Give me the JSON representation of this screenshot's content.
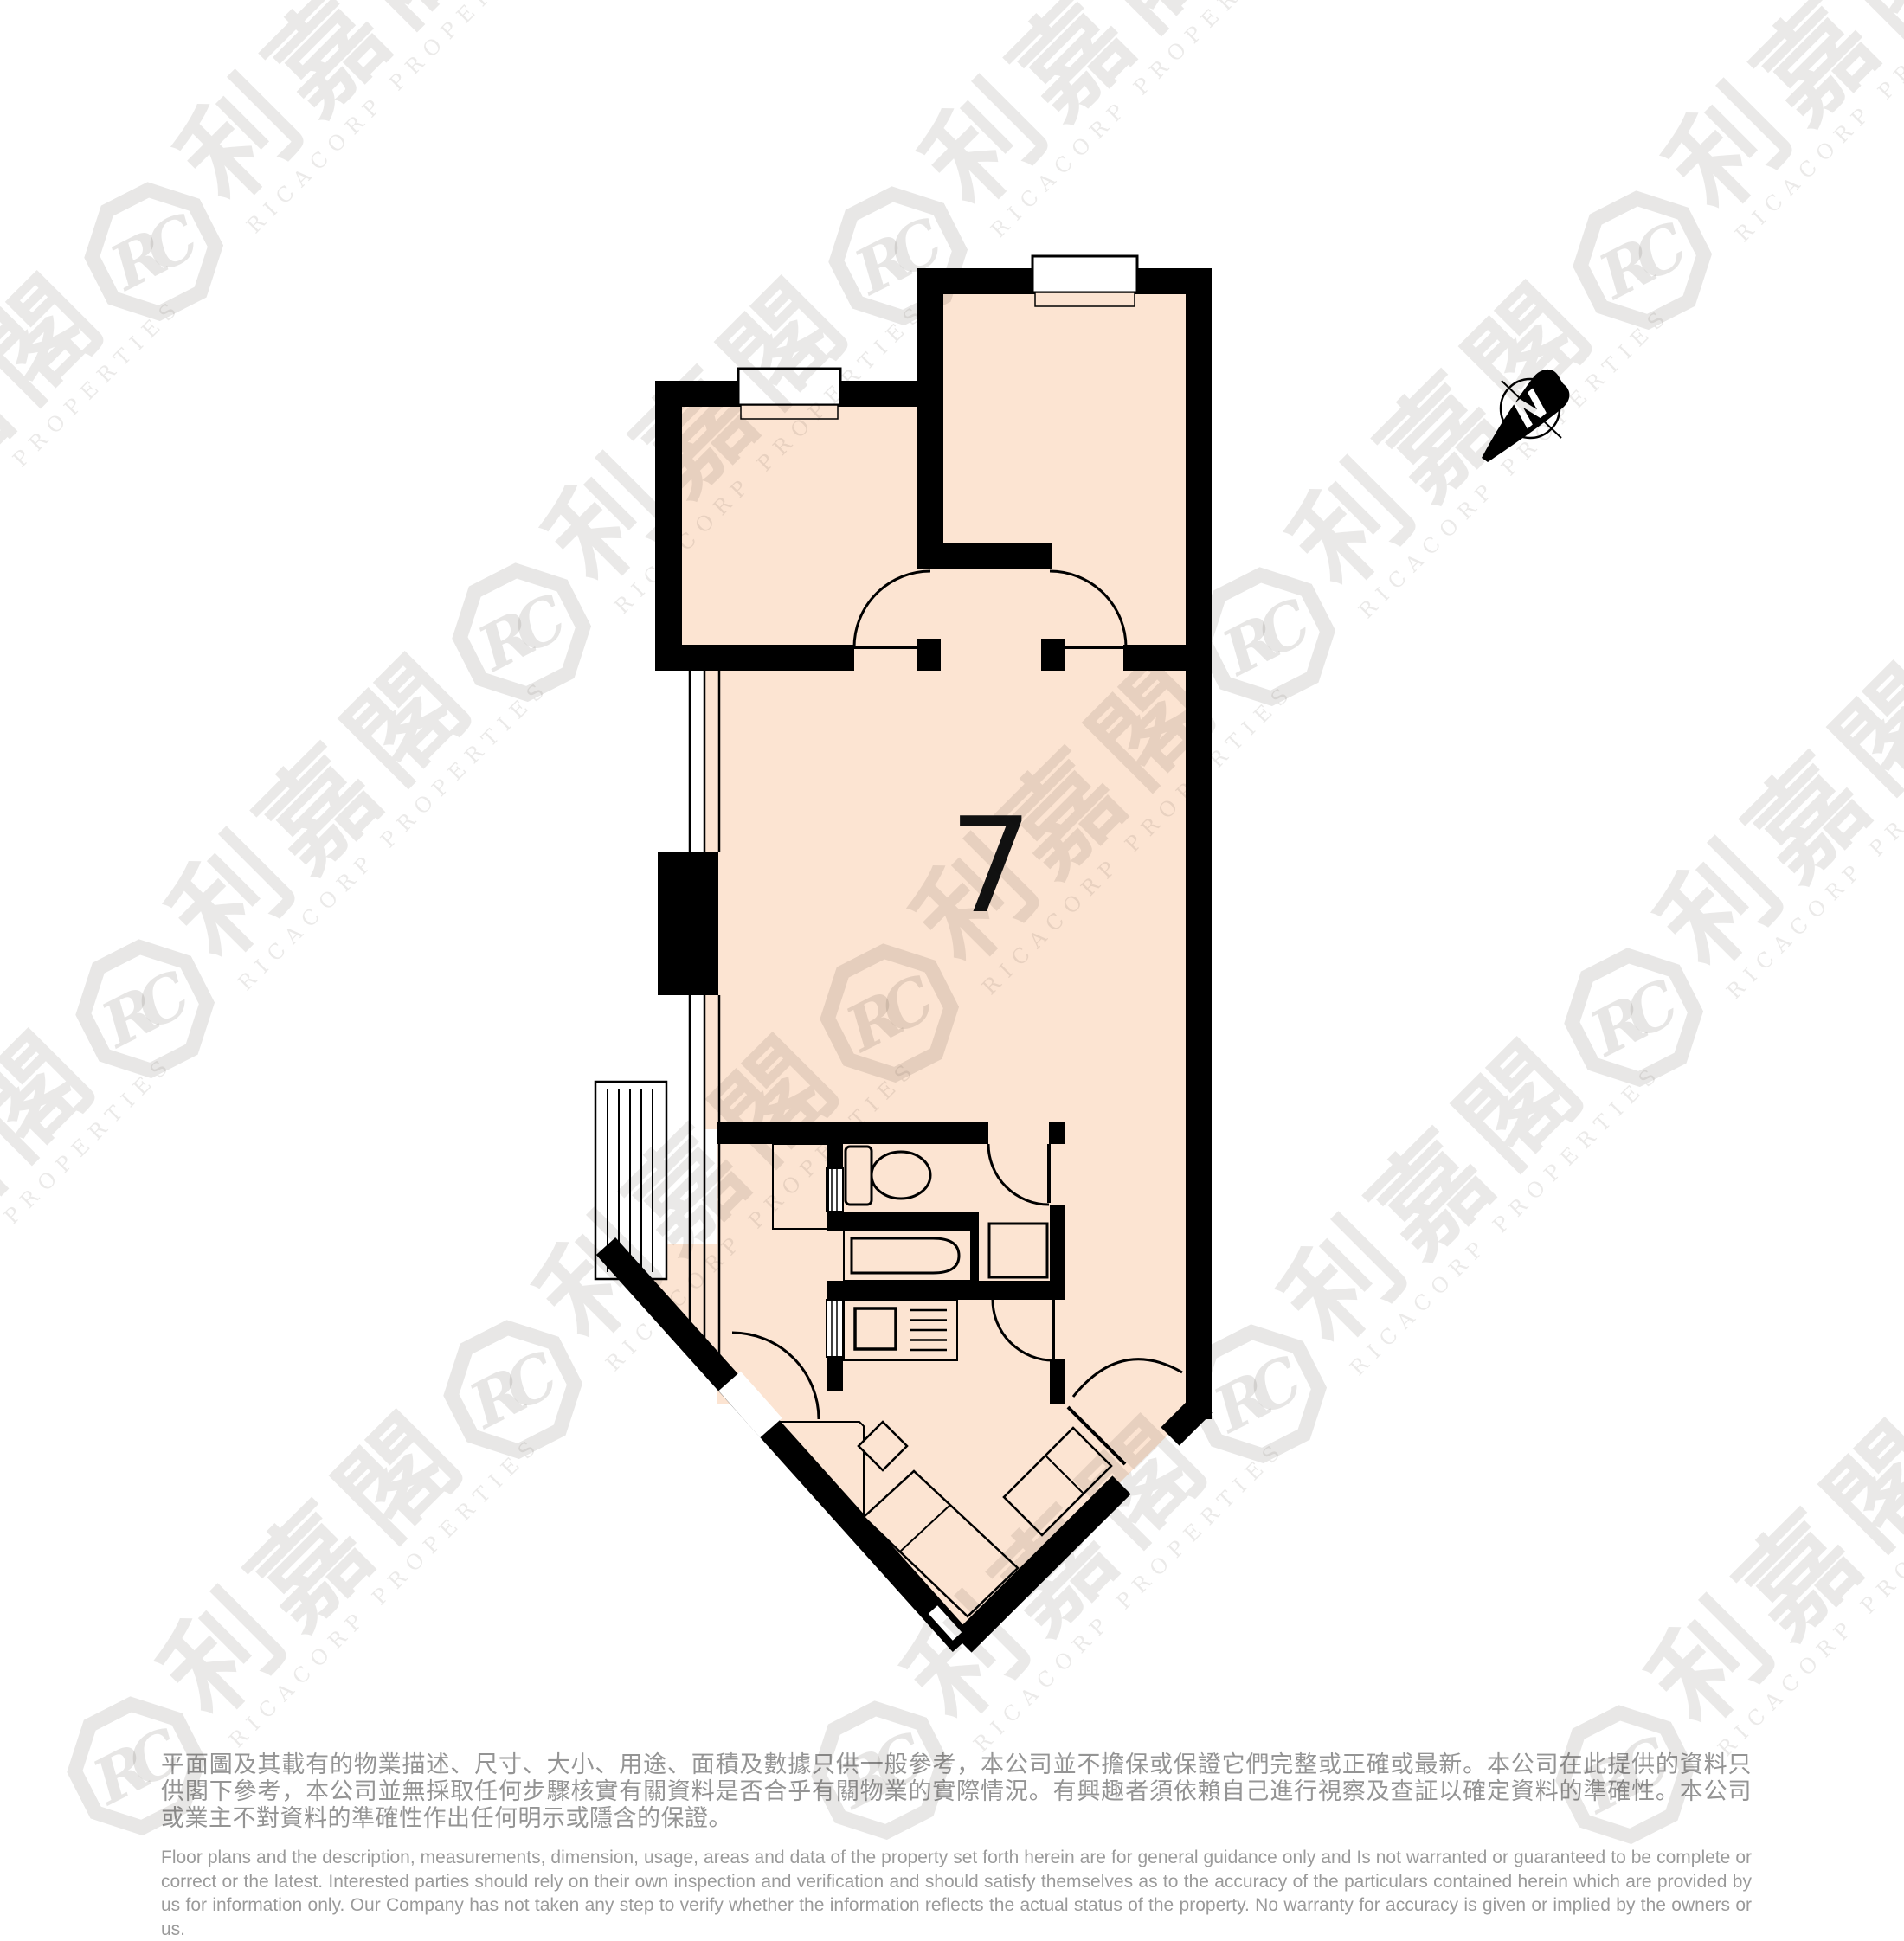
{
  "unit": {
    "number": "7"
  },
  "compass": {
    "label": "N"
  },
  "watermark": {
    "logo_text": "RC",
    "chinese": "利嘉閣",
    "english": "RICACORP PROPERTIES"
  },
  "disclaimer": {
    "chinese": "平面圖及其載有的物業描述、尺寸、大小、用途、面積及數據只供一般參考，本公司並不擔保或保證它們完整或正確或最新。本公司在此提供的資料只供閣下參考，本公司並無採取任何步驟核實有關資料是否合乎有關物業的實際情況。有興趣者須依賴自己進行視察及查証以確定資料的準確性。本公司或業主不對資料的準確性作出任何明示或隱含的保證。",
    "english": "Floor plans and the description, measurements, dimension, usage, areas and data of the property set forth herein are for general guidance only and Is not warranted or guaranteed to be complete or correct or the latest. Interested parties should rely on their own inspection and verification and should satisfy themselves as to the accuracy of the particulars contained herein which are provided by us for information only.  Our Company has not taken any step to verify whether the information reflects the actual status of the property.  No warranty for accuracy is given or implied by the owners or us."
  },
  "colors": {
    "room_fill": "#fce4d2",
    "wall": "#000000",
    "watermark_gray": "#e8e6e4",
    "disclaimer_gray": "#989898"
  }
}
